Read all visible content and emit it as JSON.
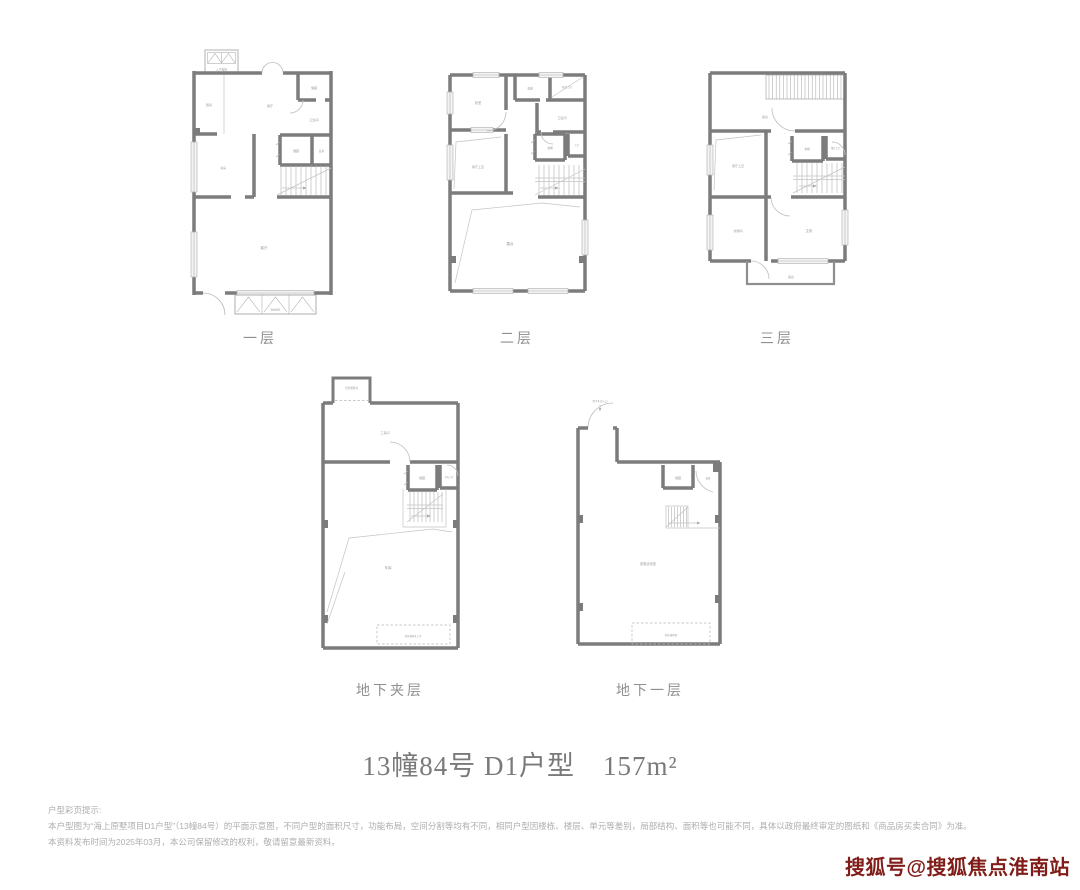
{
  "title": "13幢84号 D1户型　157m²",
  "floors": {
    "level1": {
      "label": "一层"
    },
    "level2": {
      "label": "二层"
    },
    "level3": {
      "label": "三层"
    },
    "mezzanine": {
      "label": "地下夹层"
    },
    "basement1": {
      "label": "地下一层"
    }
  },
  "rooms": {
    "level1": {
      "elevator": "入户电梯",
      "kitchen": "厨房",
      "dining": "餐厅",
      "pantry": "储藏",
      "bath": "卫生间",
      "storage": "储藏",
      "foyer": "玄关",
      "study": "书房",
      "living": "客厅",
      "courtyard": "私家庭院"
    },
    "level2": {
      "bedroom": "卧室",
      "closet_top": "衣帽",
      "void_top": "阳台上空",
      "bath": "卫生间",
      "closet_mid": "衣帽",
      "void_right": "上空",
      "void_living": "客厅上空",
      "terrace": "露台"
    },
    "level3": {
      "terrace_top": "露台",
      "void_living": "客厅上空",
      "closet": "衣帽",
      "void_terrace": "露台上空",
      "cloakroom": "衣帽间",
      "master_bedroom": "主卧",
      "terrace_bottom": "露台"
    },
    "mezzanine": {
      "vent_shaft": "室外通风井",
      "utility": "工具间",
      "storage": "储藏",
      "void_garage": "车库上空",
      "garage": "车库",
      "vent_void": "室外通风井上空"
    },
    "basement1": {
      "garage_entrance": "地下车库入口",
      "storage": "储藏",
      "equipment": "设备",
      "family_room": "家庭活动室",
      "vent_shaft": "室外通风井"
    }
  },
  "disclaimer": {
    "heading": "户型彩页提示:",
    "line1": "本户型图为“海上原墅项目D1户型”（13幢84号）的平面示意图，不同户型的面积尺寸，功能布局，空间分割等均有不同，相同户型因楼栋、楼层、单元等差别，局部结构、面积等也可能不同，具体以政府最终审定的图纸和《商品房买卖合同》为准。",
    "line2": "本资料发布时间为2025年03月，本公司保留修改的权利，敬请留意最新资料。"
  },
  "watermark": {
    "text": "搜狐号@搜狐焦点淮南站",
    "color": "#801d18"
  },
  "colors": {
    "wall": "#7c7c7c",
    "thin_line": "#c4c4c4",
    "room_label": "#9b9b9b",
    "title_text": "#7a7a7a",
    "disclaimer_text": "#aeaeae",
    "background": "#ffffff"
  }
}
